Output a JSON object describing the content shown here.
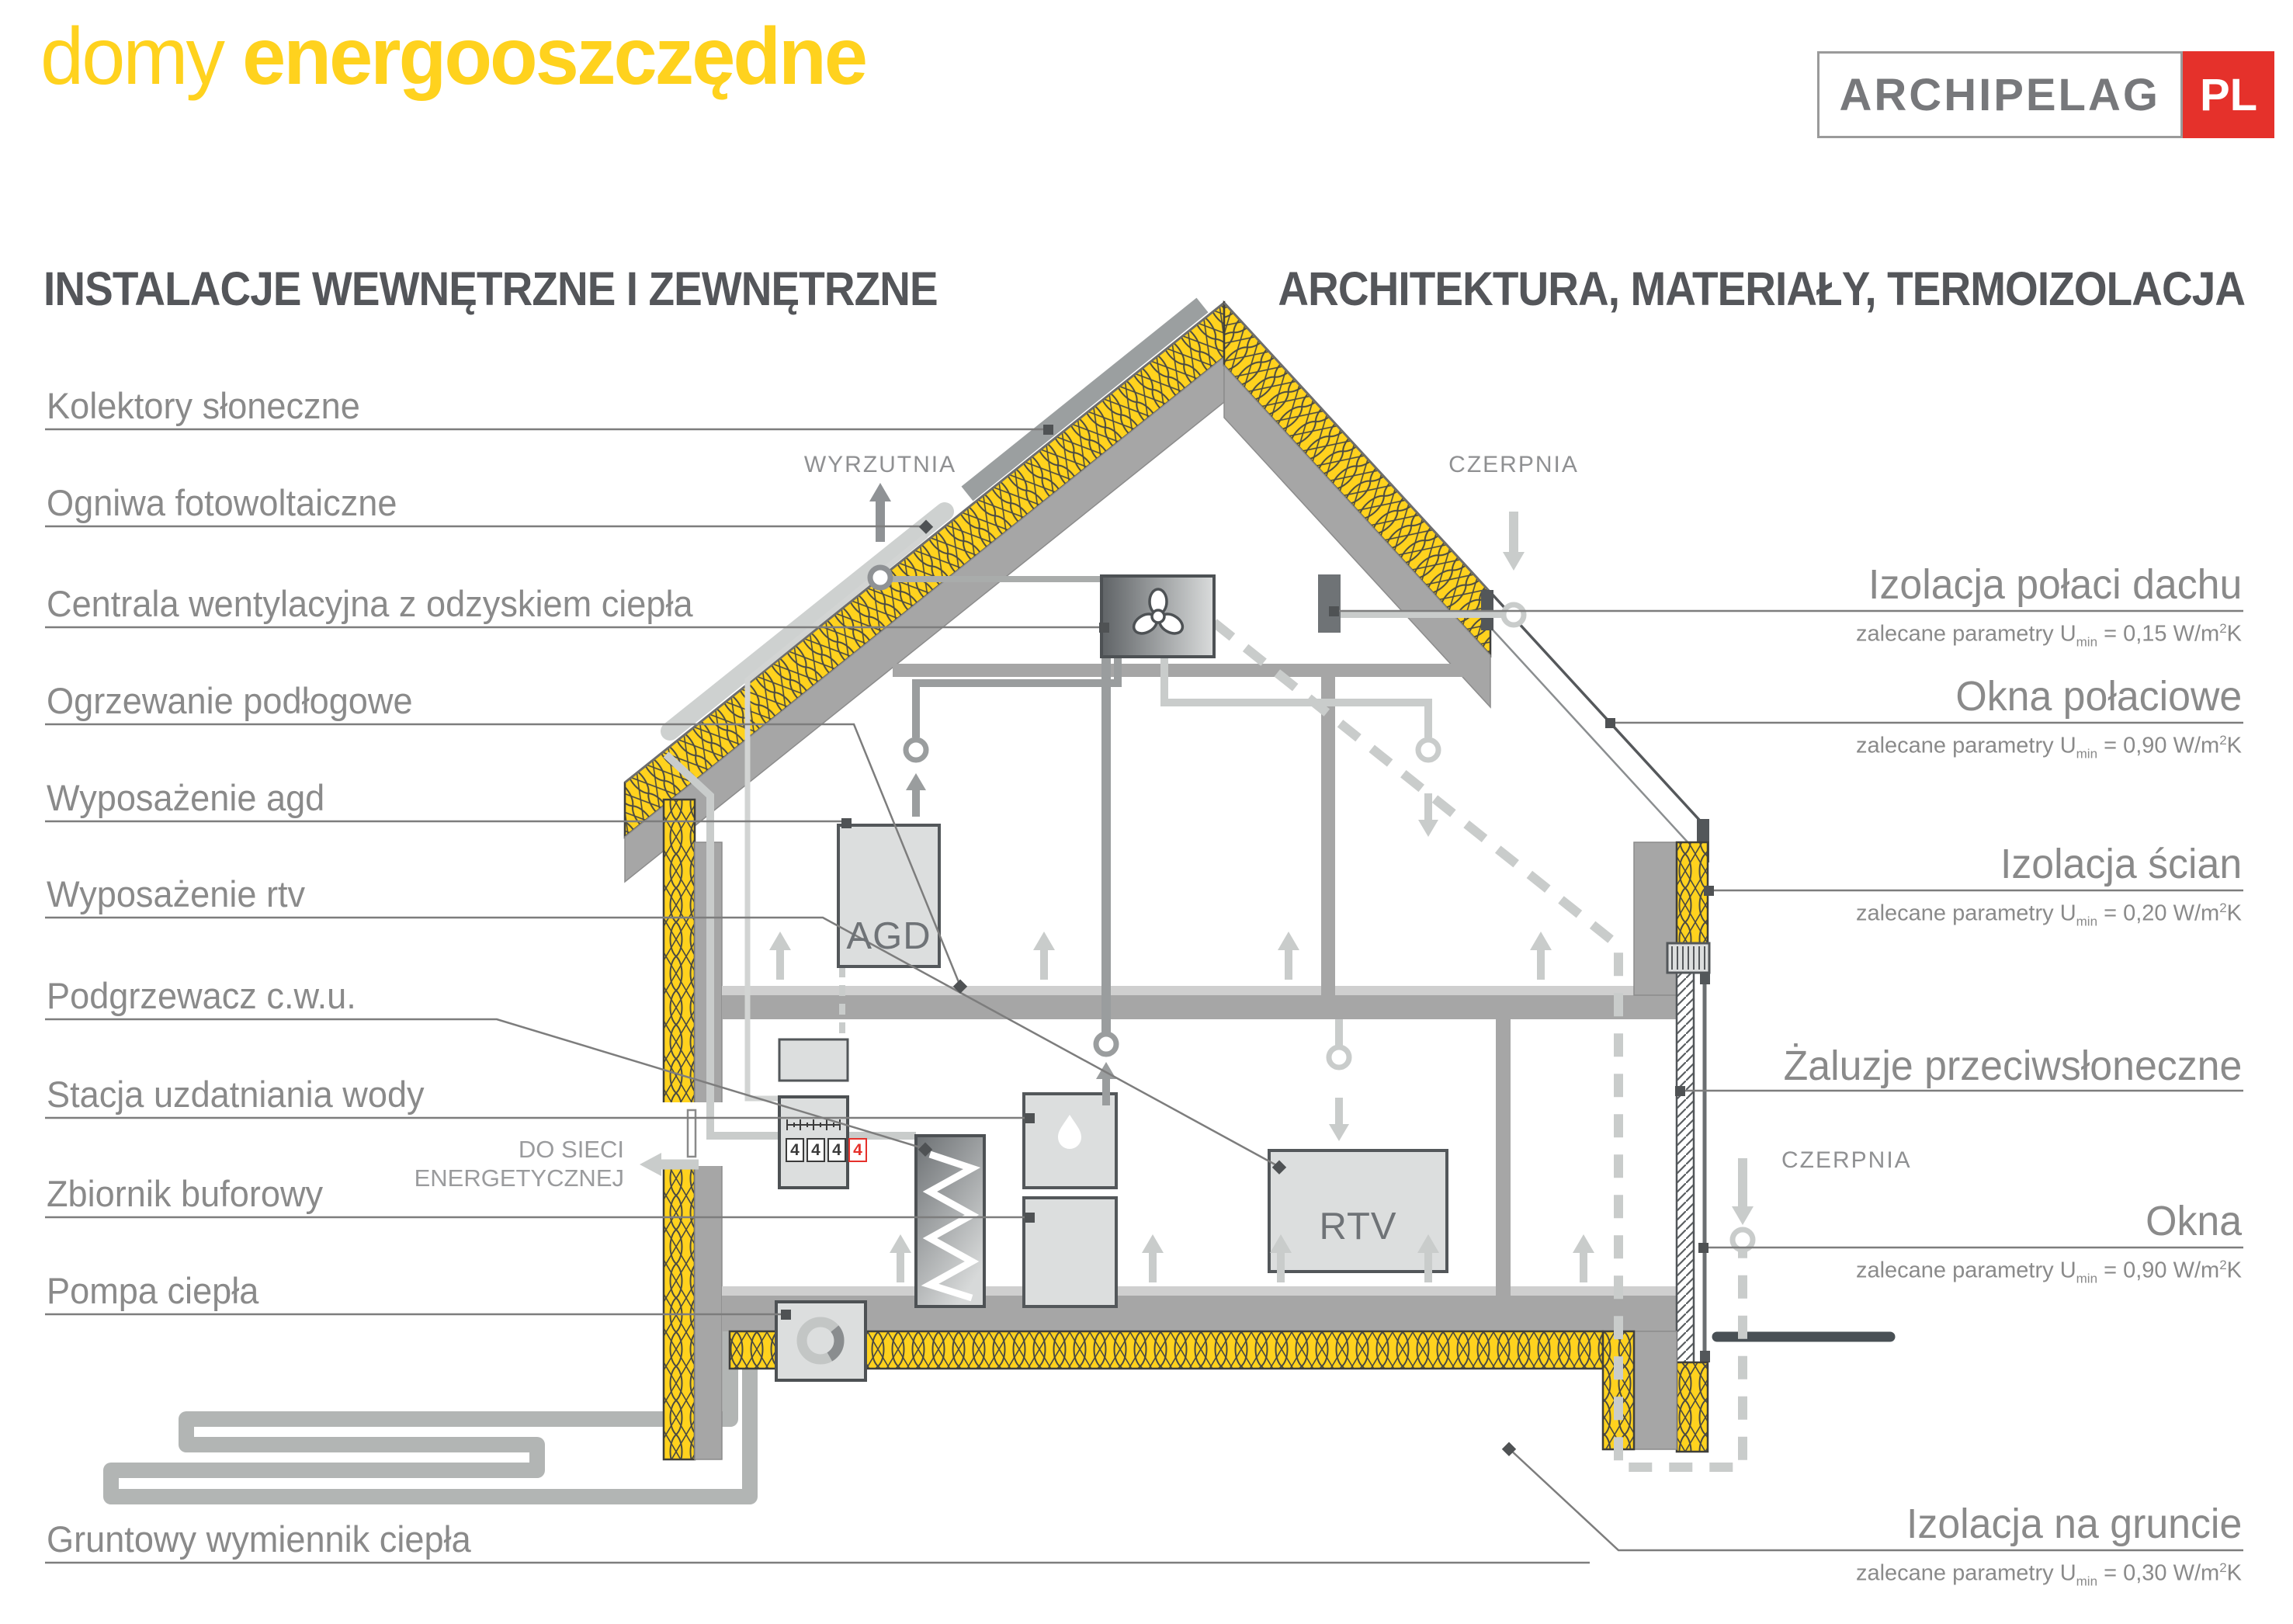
{
  "title": {
    "light": "domy",
    "bold": "energooszczędne",
    "color": "#FFD21E"
  },
  "logo": {
    "name": "ARCHIPELAG",
    "tld": "PL",
    "red": "#E5312B"
  },
  "headings": {
    "left": "INSTALACJE WEWNĘTRZNE I ZEWNĘTRZNE",
    "right": "ARCHITEKTURA, MATERIAŁY, TERMOIZOLACJA"
  },
  "left_labels": [
    {
      "label": "Kolektory słoneczne"
    },
    {
      "label": "Ogniwa fotowoltaiczne"
    },
    {
      "label": "Centrala wentylacyjna z odzyskiem ciepła"
    },
    {
      "label": "Ogrzewanie podłogowe"
    },
    {
      "label": "Wyposażenie agd"
    },
    {
      "label": "Wyposażenie rtv"
    },
    {
      "label": "Podgrzewacz c.w.u."
    },
    {
      "label": "Stacja uzdatniania wody"
    },
    {
      "label": "Zbiornik buforowy"
    },
    {
      "label": "Pompa ciepła"
    },
    {
      "label": "Gruntowy wymiennik ciepła"
    }
  ],
  "right_labels": [
    {
      "title": "Izolacja połaci dachu",
      "p1": "zalecane parametry U",
      "p2": "min",
      "p3": " = 0,15 W/m",
      "p4": "2",
      "p5": "K"
    },
    {
      "title": "Okna połaciowe",
      "p1": "zalecane parametry U",
      "p2": "min",
      "p3": " = 0,90 W/m",
      "p4": "2",
      "p5": "K"
    },
    {
      "title": "Izolacja ścian",
      "p1": "zalecane parametry U",
      "p2": "min",
      "p3": " = 0,20 W/m",
      "p4": "2",
      "p5": "K"
    },
    {
      "title": "Żaluzje przeciwsłoneczne"
    },
    {
      "title": "Okna",
      "p1": "zalecane parametry U",
      "p2": "min",
      "p3": " = 0,90 W/m",
      "p4": "2",
      "p5": "K"
    },
    {
      "title": "Izolacja na gruncie",
      "p1": "zalecane parametry U",
      "p2": "min",
      "p3": " = 0,30 W/m",
      "p4": "2",
      "p5": "K"
    }
  ],
  "diagram": {
    "wyrzutnia": "WYRZUTNIA",
    "czerpnia_roof": "CZERPNIA",
    "czerpnia_side": "CZERPNIA",
    "grid_line1": "DO SIECI",
    "grid_line2": "ENERGETYCZNEJ",
    "agd": "AGD",
    "rtv": "RTV",
    "meter_digits": [
      "4",
      "4",
      "4",
      "4"
    ]
  },
  "colors": {
    "insulation_yellow": "#FFD21E",
    "structure_gray": "#A6A6A6",
    "label_gray": "#8a8a8a",
    "heading_gray": "#54565a",
    "accent_red": "#E5312B",
    "ground_dark": "#495055"
  }
}
